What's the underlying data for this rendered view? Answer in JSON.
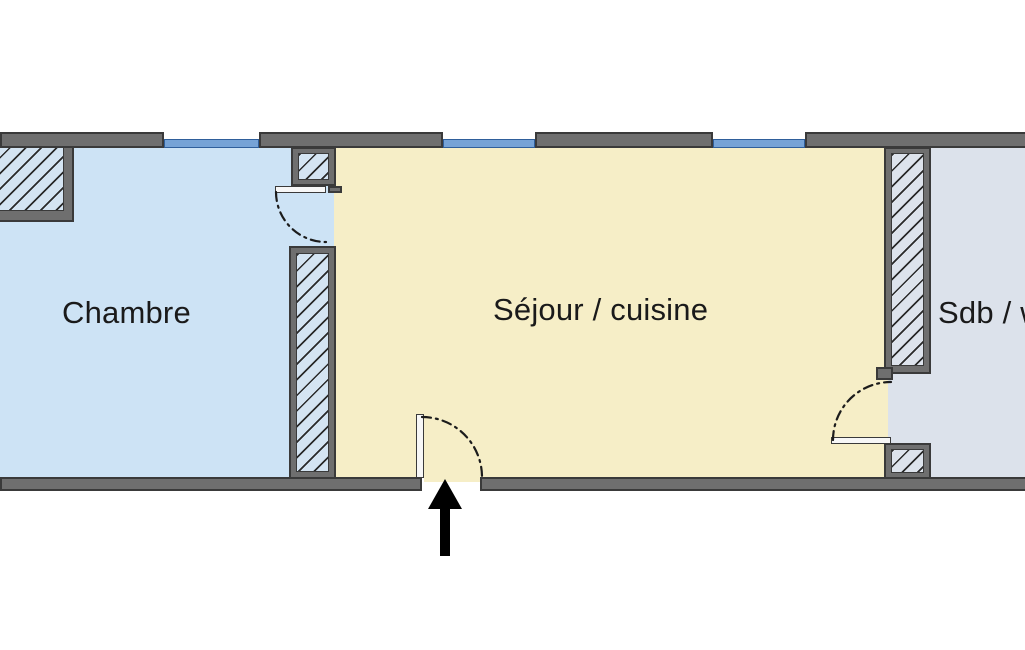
{
  "plan": {
    "rooms": [
      {
        "id": "chambre",
        "label": "Chambre",
        "fill": "#cde3f5"
      },
      {
        "id": "sejour-cuisine",
        "label": "Séjour / cuisine",
        "fill": "#f6eec7"
      },
      {
        "id": "sdb-wc",
        "label": "Sdb / w",
        "fill": "#dce2eb"
      }
    ],
    "entrance": {
      "symbol": "up-arrow",
      "description": "entrance arrow"
    },
    "colors": {
      "background": "#ffffff",
      "wall": "#6f6f6f",
      "wall_outline": "#3a3a3a",
      "window": "#76a3d6",
      "window_outline": "#2f5f9b",
      "hatch_fill": "#d4e4f2",
      "hatch_fill_gray": "#dde3ec",
      "hatch_line": "#2a2a2a",
      "door_leaf": "#f7f7f7",
      "swing_arc": "#1c1c1c",
      "arrow": "#000000",
      "label_text": "#1a1a1a"
    }
  }
}
